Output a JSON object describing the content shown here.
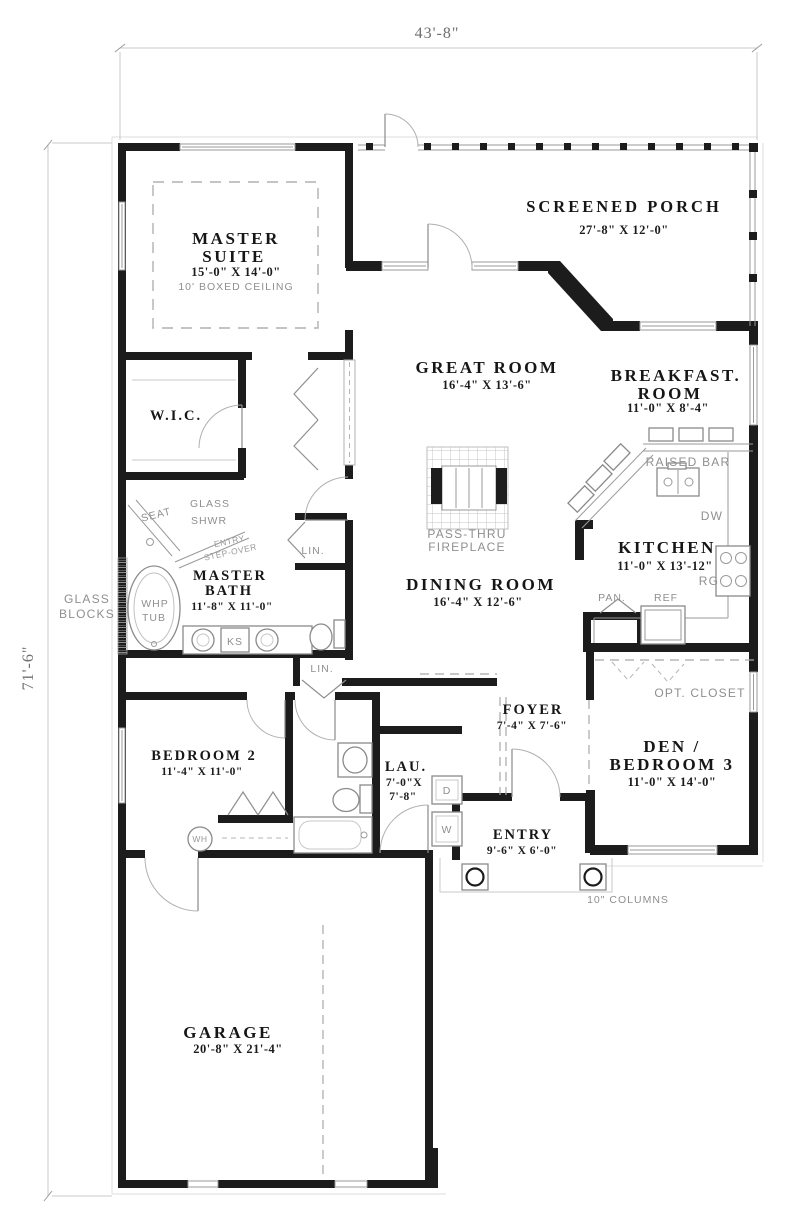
{
  "dimensions": {
    "width": "43'-8\"",
    "height": "71'-6\""
  },
  "rooms": {
    "screened_porch": {
      "name": "SCREENED PORCH",
      "size": "27'-8\" X 12'-0\""
    },
    "master_suite": {
      "name1": "MASTER",
      "name2": "SUITE",
      "size": "15'-0\" X 14'-0\"",
      "note": "10' BOXED CEILING"
    },
    "great_room": {
      "name": "GREAT ROOM",
      "size": "16'-4\" X 13'-6\""
    },
    "breakfast_room": {
      "name1": "BREAKFAST.",
      "name2": "ROOM",
      "size": "11'-0\" X 8'-4\""
    },
    "kitchen": {
      "name": "KITCHEN",
      "size": "11'-0\" X 13'-12\""
    },
    "dining_room": {
      "name": "DINING ROOM",
      "size": "16'-4\" X 12'-6\""
    },
    "master_bath": {
      "name1": "MASTER",
      "name2": "BATH",
      "size": "11'-8\" X 11'-0\""
    },
    "wic": {
      "name": "W.I.C."
    },
    "foyer": {
      "name": "FOYER",
      "size": "7'-4\" X 7'-6\""
    },
    "den": {
      "name1": "DEN /",
      "name2": "BEDROOM 3",
      "size": "11'-0\" X 14'-0\""
    },
    "bedroom_2": {
      "name": "BEDROOM 2",
      "size": "11'-4\" X 11'-0\""
    },
    "laundry": {
      "name": "LAU.",
      "size1": "7'-0\"X",
      "size2": "7'-8\""
    },
    "entry": {
      "name": "ENTRY",
      "size": "9'-6\" X 6'-0\""
    },
    "garage": {
      "name": "GARAGE",
      "size": "20'-8\" X 21'-4\""
    }
  },
  "labels": {
    "pass_thru": "PASS-THRU",
    "fireplace": "FIREPLACE",
    "raised_bar": "RAISED BAR",
    "dw": "DW",
    "rg": "RG",
    "ref": "REF",
    "pan": "PAN.",
    "opt_closet": "OPT. CLOSET",
    "lin_hall": "LIN.",
    "lin_lower": "LIN.",
    "glass": "GLASS",
    "blocks": "BLOCKS",
    "whp": "WHP",
    "tub": "TUB",
    "ks": "KS",
    "seat": "SEAT",
    "glass_shwr1": "GLASS",
    "glass_shwr2": "SHWR",
    "entry_step1": "ENTRY",
    "entry_step2": "STEP-OVER",
    "columns": "10\" COLUMNS",
    "dryer": "D",
    "washer": "W",
    "water_heater": "WH"
  },
  "colors": {
    "wall": "#1c1c1c",
    "label_gray": "#8f8f8f",
    "dim_gray": "#6f6f6f"
  }
}
